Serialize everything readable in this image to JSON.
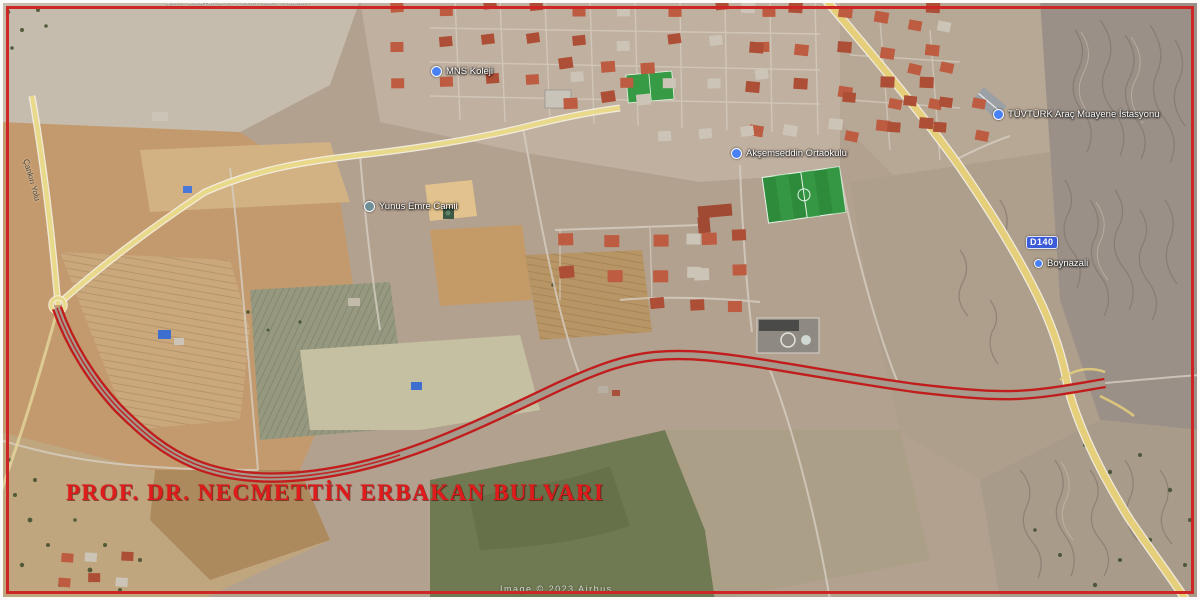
{
  "map": {
    "title": "PROF. DR. NECMETTİN ERBAKAN BULVARI",
    "route_color": "#c21d1d",
    "title_color": "#e01b1b",
    "attribution": "Image © 2023 Airbus",
    "shield": {
      "label": "D140",
      "color": "#3c5bd8"
    },
    "labels": {
      "clipped_top": "Şehir Stadyumu ve Piknik Alanı Tesisleri",
      "koleji": "MNS Koleji",
      "yunus_emre": "Yunus Emre Camii",
      "aksemseddin": "Akşemseddin Ortaokulu",
      "tuvturk": "TÜVTÜRK Araç Muayene İstasyonu",
      "bus_stop": "Boynazali",
      "left_road": "Çankırı Yolu"
    }
  }
}
